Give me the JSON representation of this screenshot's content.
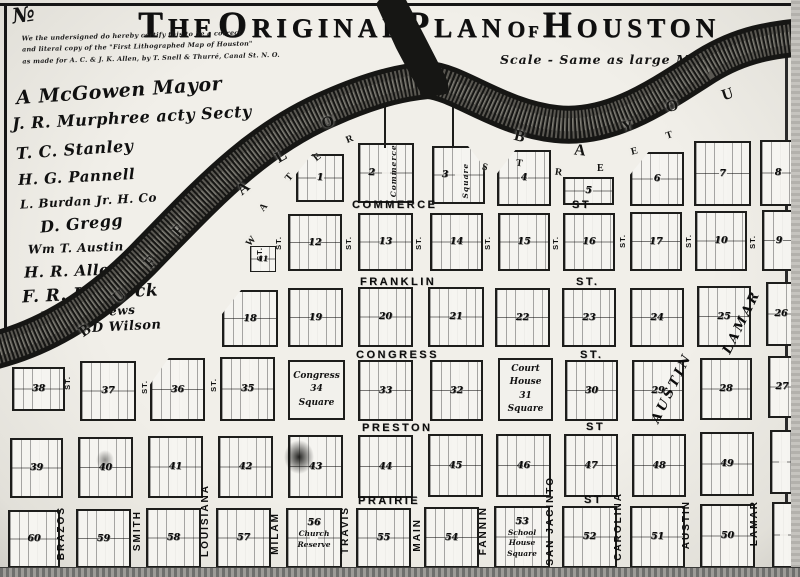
{
  "title": {
    "words": [
      {
        "t": "The"
      },
      {
        "t": "Original"
      },
      {
        "t": "Plan"
      },
      {
        "t": "of",
        "small": true
      },
      {
        "t": "Houston"
      }
    ]
  },
  "corner_mark": "№",
  "certification": {
    "lines": [
      "We the undersigned do hereby certify this to be a correct",
      "and literal copy of the \"First Lithographed Map of Houston\"",
      "as made for A. C. & J. K. Allen, by T. Snell & Thurré, Canal St. N. O."
    ]
  },
  "scale_note": "Scale -  Same as large Map",
  "signatures": [
    {
      "text": "A McGowen  Mayor",
      "x": 16,
      "y": 80,
      "s": 19,
      "r": -4
    },
    {
      "text": "J. R. Murphree  acty Secty",
      "x": 12,
      "y": 108,
      "s": 16,
      "r": -3
    },
    {
      "text": "T. C. Stanley",
      "x": 16,
      "y": 140,
      "s": 16,
      "r": -4
    },
    {
      "text": "H. G. Pannell",
      "x": 18,
      "y": 168,
      "s": 15,
      "r": -3
    },
    {
      "text": "L. Burdan  Jr. H. Co",
      "x": 20,
      "y": 194,
      "s": 12,
      "r": -3
    },
    {
      "text": "D. Gregg",
      "x": 40,
      "y": 214,
      "s": 16,
      "r": -5
    },
    {
      "text": "Wm T. Austin",
      "x": 28,
      "y": 241,
      "s": 12,
      "r": -2
    },
    {
      "text": "H. R. Allen",
      "x": 24,
      "y": 262,
      "s": 15,
      "r": -2
    },
    {
      "text": "F. R. Lubbock",
      "x": 22,
      "y": 284,
      "s": 17,
      "r": -3
    },
    {
      "text": "J. D. Andrews",
      "x": 40,
      "y": 306,
      "s": 12,
      "r": -4
    },
    {
      "text": "James T. D Wilson",
      "x": 22,
      "y": 321,
      "s": 13,
      "r": -3
    }
  ],
  "river": {
    "name": "Buffalo Bayou",
    "groups": [
      {
        "name": "buffalo-lettering",
        "size": 16,
        "letters": [
          {
            "ch": "B",
            "x": 80,
            "y": 322,
            "r": -35
          },
          {
            "ch": "U",
            "x": 114,
            "y": 288,
            "r": -40
          },
          {
            "ch": "F",
            "x": 146,
            "y": 254,
            "r": -45
          },
          {
            "ch": "F",
            "x": 174,
            "y": 222,
            "r": -48
          },
          {
            "ch": "A",
            "x": 238,
            "y": 180,
            "r": -40
          },
          {
            "ch": "L",
            "x": 276,
            "y": 148,
            "r": -30
          },
          {
            "ch": "O",
            "x": 322,
            "y": 114,
            "r": -18
          }
        ]
      },
      {
        "name": "bayou-lettering",
        "size": 16,
        "letters": [
          {
            "ch": "B",
            "x": 514,
            "y": 128,
            "r": 14
          },
          {
            "ch": "A",
            "x": 574,
            "y": 142,
            "r": 6
          },
          {
            "ch": "Y",
            "x": 622,
            "y": 118,
            "r": -12
          },
          {
            "ch": "O",
            "x": 666,
            "y": 98,
            "r": -16
          },
          {
            "ch": "U",
            "x": 722,
            "y": 86,
            "r": -18
          }
        ]
      },
      {
        "name": "water-street-lettering",
        "size": 10,
        "letters": [
          {
            "ch": "W",
            "x": 246,
            "y": 236,
            "r": -50
          },
          {
            "ch": "A",
            "x": 260,
            "y": 202,
            "r": -52
          },
          {
            "ch": "T",
            "x": 286,
            "y": 172,
            "r": -50
          },
          {
            "ch": "E",
            "x": 314,
            "y": 152,
            "r": -38
          },
          {
            "ch": "R",
            "x": 346,
            "y": 134,
            "r": -22
          },
          {
            "ch": "S",
            "x": 482,
            "y": 162,
            "r": 14
          },
          {
            "ch": "T",
            "x": 516,
            "y": 158,
            "r": 8
          },
          {
            "ch": "R",
            "x": 555,
            "y": 167,
            "r": 8
          },
          {
            "ch": "E",
            "x": 597,
            "y": 163,
            "r": 0
          },
          {
            "ch": "E",
            "x": 631,
            "y": 146,
            "r": -14
          },
          {
            "ch": "T",
            "x": 666,
            "y": 130,
            "r": -18
          }
        ]
      }
    ]
  },
  "streets": {
    "st_text": "ST.",
    "horizontal": [
      {
        "label": "COMMERCE",
        "x": 352,
        "y": 199
      },
      {
        "label": "ST",
        "x": 572,
        "y": 199
      },
      {
        "label": "FRANKLIN",
        "x": 360,
        "y": 276
      },
      {
        "label": "ST.",
        "x": 576,
        "y": 276
      },
      {
        "label": "CONGRESS",
        "x": 356,
        "y": 349
      },
      {
        "label": "ST.",
        "x": 580,
        "y": 349
      },
      {
        "label": "PRESTON",
        "x": 362,
        "y": 422
      },
      {
        "label": "ST",
        "x": 586,
        "y": 421
      },
      {
        "label": "PRAIRIE",
        "x": 358,
        "y": 495
      },
      {
        "label": "ST",
        "x": 584,
        "y": 494
      }
    ],
    "vertical": [
      {
        "label": "BRAZOS",
        "x": 56,
        "y": 506
      },
      {
        "label": "SMITH",
        "x": 132,
        "y": 510
      },
      {
        "label": "LOUISIANA",
        "x": 200,
        "y": 484
      },
      {
        "label": "MILAM",
        "x": 270,
        "y": 512
      },
      {
        "label": "TRAVIS",
        "x": 340,
        "y": 506
      },
      {
        "label": "MAIN",
        "x": 412,
        "y": 518
      },
      {
        "label": "FANNIN",
        "x": 478,
        "y": 506
      },
      {
        "label": "SAN JACINTO",
        "x": 545,
        "y": 476
      },
      {
        "label": "CAROLINA",
        "x": 613,
        "y": 492
      },
      {
        "label": "AUSTIN",
        "x": 681,
        "y": 500
      },
      {
        "label": "LAMAR",
        "x": 749,
        "y": 500
      }
    ],
    "diagonal": [
      {
        "label": "AUSTIN",
        "x": 672,
        "y": 388,
        "r": -64
      },
      {
        "label": "LAMAR",
        "x": 742,
        "y": 322,
        "r": -64
      }
    ],
    "st_marks": [
      {
        "x": 255,
        "y": 247
      },
      {
        "x": 274,
        "y": 236
      },
      {
        "x": 344,
        "y": 236
      },
      {
        "x": 414,
        "y": 236
      },
      {
        "x": 483,
        "y": 236
      },
      {
        "x": 551,
        "y": 236
      },
      {
        "x": 618,
        "y": 234
      },
      {
        "x": 684,
        "y": 234
      },
      {
        "x": 748,
        "y": 235
      },
      {
        "x": 63,
        "y": 376
      },
      {
        "x": 140,
        "y": 380
      },
      {
        "x": 209,
        "y": 378
      }
    ]
  },
  "blocks": [
    {
      "n": "1",
      "x": 296,
      "y": 154,
      "w": 48,
      "h": 48,
      "clip": "tl"
    },
    {
      "n": "2",
      "x": 358,
      "y": 143,
      "w": 56,
      "h": 60,
      "vtext": "Commerce"
    },
    {
      "n": "3",
      "x": 432,
      "y": 146,
      "w": 53,
      "h": 58,
      "clip": "tr",
      "vtext": "Square"
    },
    {
      "n": "4",
      "x": 497,
      "y": 150,
      "w": 54,
      "h": 56,
      "clip": "tl"
    },
    {
      "n": "5",
      "x": 563,
      "y": 177,
      "w": 51,
      "h": 28
    },
    {
      "n": "6",
      "x": 630,
      "y": 152,
      "w": 54,
      "h": 54,
      "clip": "tl"
    },
    {
      "n": "7",
      "x": 694,
      "y": 141,
      "w": 57,
      "h": 65
    },
    {
      "n": "8",
      "x": 760,
      "y": 140,
      "w": 36,
      "h": 66
    },
    {
      "n": "11",
      "x": 250,
      "y": 246,
      "w": 26,
      "h": 26,
      "small": true
    },
    {
      "n": "12",
      "x": 288,
      "y": 214,
      "w": 54,
      "h": 57
    },
    {
      "n": "13",
      "x": 358,
      "y": 213,
      "w": 55,
      "h": 58
    },
    {
      "n": "14",
      "x": 430,
      "y": 213,
      "w": 53,
      "h": 58
    },
    {
      "n": "15",
      "x": 498,
      "y": 213,
      "w": 52,
      "h": 58
    },
    {
      "n": "16",
      "x": 563,
      "y": 213,
      "w": 52,
      "h": 58
    },
    {
      "n": "17",
      "x": 630,
      "y": 212,
      "w": 52,
      "h": 59
    },
    {
      "n": "10",
      "x": 695,
      "y": 211,
      "w": 52,
      "h": 60
    },
    {
      "n": "9",
      "x": 762,
      "y": 210,
      "w": 34,
      "h": 61
    },
    {
      "n": "18",
      "x": 222,
      "y": 290,
      "w": 56,
      "h": 57,
      "clip": "tl"
    },
    {
      "n": "19",
      "x": 288,
      "y": 288,
      "w": 55,
      "h": 59
    },
    {
      "n": "20",
      "x": 358,
      "y": 287,
      "w": 55,
      "h": 60
    },
    {
      "n": "21",
      "x": 428,
      "y": 287,
      "w": 56,
      "h": 60
    },
    {
      "n": "22",
      "x": 495,
      "y": 288,
      "w": 55,
      "h": 59
    },
    {
      "n": "23",
      "x": 562,
      "y": 288,
      "w": 54,
      "h": 59
    },
    {
      "n": "24",
      "x": 630,
      "y": 288,
      "w": 54,
      "h": 59
    },
    {
      "n": "25",
      "x": 697,
      "y": 286,
      "w": 54,
      "h": 61
    },
    {
      "n": "26",
      "x": 766,
      "y": 282,
      "w": 30,
      "h": 64
    },
    {
      "n": "38",
      "x": 12,
      "y": 367,
      "w": 53,
      "h": 44
    },
    {
      "n": "37",
      "x": 80,
      "y": 361,
      "w": 56,
      "h": 60
    },
    {
      "n": "36",
      "x": 150,
      "y": 358,
      "w": 55,
      "h": 63,
      "clip": "tl"
    },
    {
      "n": "35",
      "x": 220,
      "y": 357,
      "w": 55,
      "h": 64
    },
    {
      "type": "square",
      "lines": [
        "Congress",
        "34",
        "Square"
      ],
      "x": 288,
      "y": 360,
      "w": 57,
      "h": 60
    },
    {
      "n": "33",
      "x": 358,
      "y": 360,
      "w": 55,
      "h": 61
    },
    {
      "n": "32",
      "x": 430,
      "y": 360,
      "w": 53,
      "h": 61
    },
    {
      "type": "square",
      "lines": [
        "Court House",
        "31",
        "Square"
      ],
      "x": 498,
      "y": 358,
      "w": 55,
      "h": 63
    },
    {
      "n": "30",
      "x": 565,
      "y": 360,
      "w": 53,
      "h": 61
    },
    {
      "n": "29",
      "x": 632,
      "y": 360,
      "w": 52,
      "h": 61
    },
    {
      "n": "28",
      "x": 700,
      "y": 358,
      "w": 52,
      "h": 62
    },
    {
      "n": "27",
      "x": 768,
      "y": 356,
      "w": 28,
      "h": 62
    },
    {
      "n": "39",
      "x": 10,
      "y": 438,
      "w": 53,
      "h": 60
    },
    {
      "n": "40",
      "x": 78,
      "y": 437,
      "w": 55,
      "h": 61
    },
    {
      "n": "41",
      "x": 148,
      "y": 436,
      "w": 55,
      "h": 62
    },
    {
      "n": "42",
      "x": 218,
      "y": 436,
      "w": 55,
      "h": 62
    },
    {
      "n": "43",
      "x": 288,
      "y": 435,
      "w": 55,
      "h": 63
    },
    {
      "n": "44",
      "x": 358,
      "y": 435,
      "w": 55,
      "h": 63
    },
    {
      "n": "45",
      "x": 428,
      "y": 434,
      "w": 55,
      "h": 63
    },
    {
      "n": "46",
      "x": 496,
      "y": 434,
      "w": 55,
      "h": 63
    },
    {
      "n": "47",
      "x": 564,
      "y": 434,
      "w": 54,
      "h": 63
    },
    {
      "n": "48",
      "x": 632,
      "y": 434,
      "w": 54,
      "h": 63
    },
    {
      "n": "49",
      "x": 700,
      "y": 432,
      "w": 54,
      "h": 64
    },
    {
      "n": "",
      "x": 770,
      "y": 430,
      "w": 26,
      "h": 64
    },
    {
      "n": "60",
      "x": 8,
      "y": 510,
      "w": 52,
      "h": 58
    },
    {
      "n": "59",
      "x": 76,
      "y": 509,
      "w": 55,
      "h": 59
    },
    {
      "n": "58",
      "x": 146,
      "y": 508,
      "w": 55,
      "h": 60
    },
    {
      "n": "57",
      "x": 216,
      "y": 508,
      "w": 55,
      "h": 60
    },
    {
      "type": "reserve",
      "n": "56",
      "lines": [
        "Church",
        "Reserve"
      ],
      "x": 286,
      "y": 508,
      "w": 56,
      "h": 60
    },
    {
      "n": "55",
      "x": 356,
      "y": 508,
      "w": 55,
      "h": 60
    },
    {
      "n": "54",
      "x": 424,
      "y": 507,
      "w": 55,
      "h": 61
    },
    {
      "type": "reserve",
      "n": "53",
      "lines": [
        "School House",
        "Square"
      ],
      "x": 494,
      "y": 506,
      "w": 56,
      "h": 62
    },
    {
      "n": "52",
      "x": 562,
      "y": 506,
      "w": 55,
      "h": 62
    },
    {
      "n": "51",
      "x": 630,
      "y": 506,
      "w": 55,
      "h": 62
    },
    {
      "n": "50",
      "x": 700,
      "y": 504,
      "w": 55,
      "h": 64
    },
    {
      "n": "",
      "x": 772,
      "y": 502,
      "w": 24,
      "h": 66
    }
  ],
  "ink": "#1a1a18",
  "paper": "#f1efe9"
}
